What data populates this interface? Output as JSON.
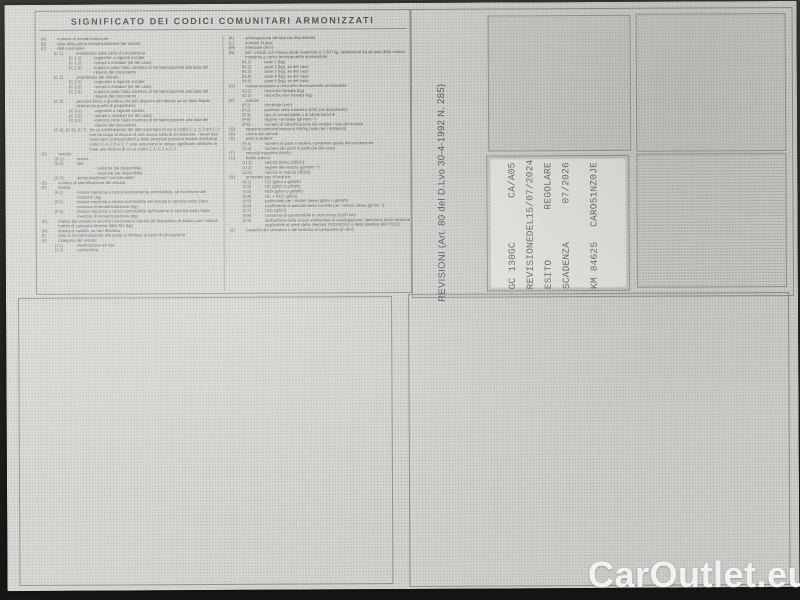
{
  "watermark": "CarOutlet.eu",
  "colors": {
    "paper": "#d7d5d1",
    "panel_border": "#8f8d89",
    "legend_ink": "#5c5a5c",
    "stamp_ink": "#66666f",
    "watermark": "#fbfbfa",
    "photo_background": "#23231f"
  },
  "legend": {
    "title": "SIGNIFICATO DEI CODICI COMUNITARI ARMONIZZATI",
    "left_column": [
      {
        "c": "(A)",
        "t": "numero di immatricolazione",
        "l": "lvl0"
      },
      {
        "c": "(B)",
        "t": "data della prima immatricolazione del veicolo",
        "l": "lvl0"
      },
      {
        "c": "(C)",
        "t": "dati nominativi:",
        "l": "lvl0"
      },
      {
        "c": "(C.1)",
        "t": "intestatario della carta di circolazione:",
        "l": "lvl1"
      },
      {
        "c": "(C.1.1)",
        "t": "cognome o ragione sociale",
        "l": "lvl2"
      },
      {
        "c": "(C.1.2)",
        "t": "nome/i o iniziale/i (se del caso)",
        "l": "lvl2"
      },
      {
        "c": "(C.1.3)",
        "t": "indirizzo nello Stato membro di immatricolazione alla data del rilascio del documento",
        "l": "lvl2"
      },
      {
        "c": "(C.2)",
        "t": "proprietario del veicolo:",
        "l": "lvl1"
      },
      {
        "c": "(C.2.1)",
        "t": "cognome o ragione sociale",
        "l": "lvl2"
      },
      {
        "c": "(C.2.2)",
        "t": "nome/i o iniziale/i (se del caso)",
        "l": "lvl2"
      },
      {
        "c": "(C.2.3)",
        "t": "indirizzo nello Stato membro di immatricolazione alla data del rilascio del documento",
        "l": "lvl2"
      },
      {
        "c": "(C.3)",
        "t": "persona fisica o giuridica che può disporre del veicolo ad un titolo legale diverso da quello di proprietario:",
        "l": "lvl1"
      },
      {
        "c": "(C.3.1)",
        "t": "cognome o ragione sociale",
        "l": "lvl2"
      },
      {
        "c": "(C.3.2)",
        "t": "nome/i o iniziale/i (se del caso)",
        "l": "lvl2"
      },
      {
        "c": "(C.3.3)",
        "t": "indirizzo nello Stato membro di immatricolazione alla data del rilascio del documento",
        "l": "lvl2"
      },
      {
        "c": "(C.4), (C.6), (C.7)",
        "t": "Se un cambiamento dei dati nominativi di cui ai codici C.1, C.2 e/o C.3 non dà luogo al rilascio di una nuova carta di circolazione, i nuovi dati nominativi corrispondenti a dette posizioni possono essere riportati ai codici C.4, C.6 e C.7; essi assumono lo stesso significato attribuito in base alla dicitura di cui ai codici C.1, C.2 e C.3",
        "l": "lvl1"
      },
      {
        "c": "(D)",
        "t": "veicolo:",
        "l": "lvl0"
      },
      {
        "c": "(D.1)",
        "t": "marca",
        "l": "lvl1"
      },
      {
        "c": "(D.2)",
        "t": "tipo",
        "l": "lvl1"
      },
      {
        "c": "",
        "t": "- variante (se disponibile)",
        "l": "lvl2"
      },
      {
        "c": "",
        "t": "- versione (se disponibile)",
        "l": "lvl2"
      },
      {
        "c": "(D.3)",
        "t": "denominazione/i commerciale/i",
        "l": "lvl1"
      },
      {
        "c": "(E)",
        "t": "numero di identificazione del veicolo",
        "l": "lvl0"
      },
      {
        "c": "(F)",
        "t": "massa:",
        "l": "lvl0"
      },
      {
        "c": "(F.1)",
        "t": "massa massima a carico tecnicamente ammissibile, ad eccezione dei motocicli (kg)",
        "l": "lvl1"
      },
      {
        "c": "(F.2)",
        "t": "massa massima a carico ammissibile del veicolo in servizio nello Stato membro di immatricolazione (kg)",
        "l": "lvl1"
      },
      {
        "c": "(F.3)",
        "t": "massa massima a carico ammissibile dell'insieme in servizio nello Stato membro di immatricolazione (kg)",
        "l": "lvl1"
      },
      {
        "c": "(G)",
        "t": "massa del veicolo in servizio carrozzato e munito del dispositivo di attacco per i veicoli trattori di categoria diversa dalla M1 (kg)",
        "l": "lvl0"
      },
      {
        "c": "(H)",
        "t": "durata di validità, se non illimitata",
        "l": "lvl0"
      },
      {
        "c": "(I)",
        "t": "data di immatricolazione alla quale si riferisce la carta di circolazione",
        "l": "lvl0"
      },
      {
        "c": "(J)",
        "t": "categoria del veicolo:",
        "l": "lvl0"
      },
      {
        "c": "(J.1)",
        "t": "destinazione ed uso",
        "l": "lvl1"
      },
      {
        "c": "(J.2)",
        "t": "carrozzeria",
        "l": "lvl1"
      }
    ],
    "right_column": [
      {
        "c": "(K)",
        "t": "omologazione del tipo (se disponibile)",
        "l": "lvl0"
      },
      {
        "c": "(L)",
        "t": "numero di assi",
        "l": "lvl0"
      },
      {
        "c": "(M)",
        "t": "interasse (mm)",
        "l": "lvl0"
      },
      {
        "c": "(N)",
        "t": "per i veicoli con massa totale superiore a 3.500 kg, ripartizione fra gli assi della massa massima a carico tecnicamente ammissibile:",
        "l": "lvl0"
      },
      {
        "c": "(N.1)",
        "t": "asse 1 (kg)",
        "l": "lvl1"
      },
      {
        "c": "(N.2)",
        "t": "asse 2 (kg), se del caso",
        "l": "lvl1"
      },
      {
        "c": "(N.3)",
        "t": "asse 3 (kg), se del caso",
        "l": "lvl1"
      },
      {
        "c": "(N.4)",
        "t": "asse 4 (kg), se del caso",
        "l": "lvl1"
      },
      {
        "c": "(N.5)",
        "t": "asse 5 (kg), se del caso",
        "l": "lvl1"
      },
      {
        "c": "(O)",
        "t": "massa massima a rimorchio tecnicamente ammissibile:",
        "l": "lvl0"
      },
      {
        "c": "(O.1)",
        "t": "rimorchio frenato (kg)",
        "l": "lvl1"
      },
      {
        "c": "(O.2)",
        "t": "rimorchio non frenato (kg)",
        "l": "lvl1"
      },
      {
        "c": "(P)",
        "t": "motore:",
        "l": "lvl0"
      },
      {
        "c": "(P.1)",
        "t": "cilindrata (cm³)",
        "l": "lvl1"
      },
      {
        "c": "(P.2)",
        "t": "potenza netta massima (kW) (se disponibile)",
        "l": "lvl1"
      },
      {
        "c": "(P.3)",
        "t": "tipo di combustibile o di alimentazione",
        "l": "lvl1"
      },
      {
        "c": "(P.4)",
        "t": "regime nominale (giri/min⁻¹)",
        "l": "lvl1"
      },
      {
        "c": "(P.5)",
        "t": "numero di identificazione del motore / tipo del motore",
        "l": "lvl1"
      },
      {
        "c": "(Q)",
        "t": "rapporto potenza/massa in kW/kg (solo per i motocicli)",
        "l": "lvl0"
      },
      {
        "c": "(R)",
        "t": "colore del veicolo",
        "l": "lvl0"
      },
      {
        "c": "(S)",
        "t": "posti a sedere:",
        "l": "lvl0"
      },
      {
        "c": "(S.1)",
        "t": "numero di posti a sedere, compreso quello del conducente",
        "l": "lvl1"
      },
      {
        "c": "(S.2)",
        "t": "numero dei posti in piedi (se del caso)",
        "l": "lvl1"
      },
      {
        "c": "(T)",
        "t": "velocità massima (km/h)",
        "l": "lvl0"
      },
      {
        "c": "(U)",
        "t": "livello sonoro:",
        "l": "lvl0"
      },
      {
        "c": "(U.1)",
        "t": "veicolo fermo (dB(A))",
        "l": "lvl1"
      },
      {
        "c": "(U.2)",
        "t": "regime del motore (giri/min⁻¹)",
        "l": "lvl1"
      },
      {
        "c": "(U.3)",
        "t": "veicolo in marcia (dB(A))",
        "l": "lvl1"
      },
      {
        "c": "(V)",
        "t": "emissioni gas di scarico:",
        "l": "lvl0"
      },
      {
        "c": "(V.1)",
        "t": "CO (g/km o g/kWh)",
        "l": "lvl1"
      },
      {
        "c": "(V.2)",
        "t": "HC (g/km o g/kWh)",
        "l": "lvl1"
      },
      {
        "c": "(V.3)",
        "t": "NOx (g/km o g/kWh)",
        "l": "lvl1"
      },
      {
        "c": "(V.4)",
        "t": "HC + NOx (g/km)",
        "l": "lvl1"
      },
      {
        "c": "(V.5)",
        "t": "particolato per i motori diesel (g/km o g/kWh)",
        "l": "lvl1"
      },
      {
        "c": "(V.6)",
        "t": "coefficiente di assorbimento corretto per i motori diesel (g/min⁻¹)",
        "l": "lvl1"
      },
      {
        "c": "(V.7)",
        "t": "CO₂ (g/km)",
        "l": "lvl1"
      },
      {
        "c": "(V.8)",
        "t": "consumo di combustibile in ciclo misto (l/100 km)",
        "l": "lvl1"
      },
      {
        "c": "(V.9)",
        "t": "indicazione della classe ambientale di omologazione; menzione della versione applicabile ai sensi della direttiva 70/220/CEE o della direttiva 88/77/CEE",
        "l": "lvl1"
      },
      {
        "c": "(Z)",
        "t": "capacità del serbatoio o dei serbatoi di carburante (in dm³)",
        "l": "lvl0"
      }
    ]
  },
  "revisioni": {
    "label": "REVISIONI (Art. 80 del D.Lvo 30-4-1992 N. 285)",
    "stamp_lines": [
      {
        "a": "GC 130GC",
        "b": "CA/A05",
        "g": ""
      },
      {
        "a": "REVISIONE",
        "b": "DEL15/07/2024",
        "g": ""
      },
      {
        "a": "ESITO",
        "b": "REGOLARE",
        "g": ""
      },
      {
        "a": "SCADENZA",
        "b": "07/2026",
        "g": ""
      },
      {
        "a": "KM 84625",
        "b": "CARO51NZ0JE",
        "g": "gap"
      }
    ]
  }
}
